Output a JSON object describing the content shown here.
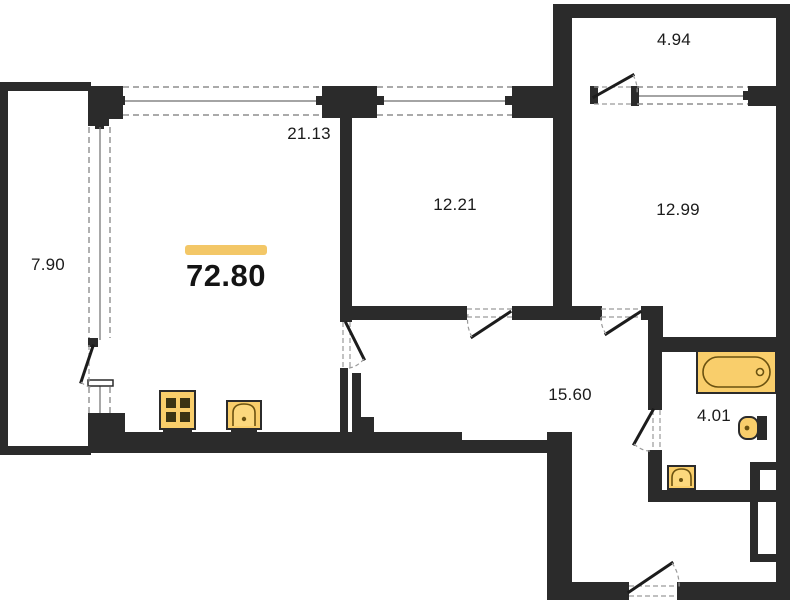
{
  "plan": {
    "total": {
      "area": "72.80"
    },
    "rooms": {
      "balcony_left": "7.90",
      "living_kitchen": "21.13",
      "room_a": "12.21",
      "room_b": "12.99",
      "balcony_top": "4.94",
      "hallway": "15.60",
      "bathroom": "4.01"
    },
    "colors": {
      "wall": "#2b2b2b",
      "fixture_fill": "#f9ce6b",
      "accent_bar": "#f3c767",
      "background": "#ffffff"
    },
    "icons": {
      "stove": "stove-icon",
      "kitchen_sink": "kitchen-sink-icon",
      "bathtub": "bathtub-icon",
      "toilet": "toilet-icon",
      "washbasin": "washbasin-icon",
      "window": "window-glyph",
      "door": "door-swing-glyph"
    }
  }
}
